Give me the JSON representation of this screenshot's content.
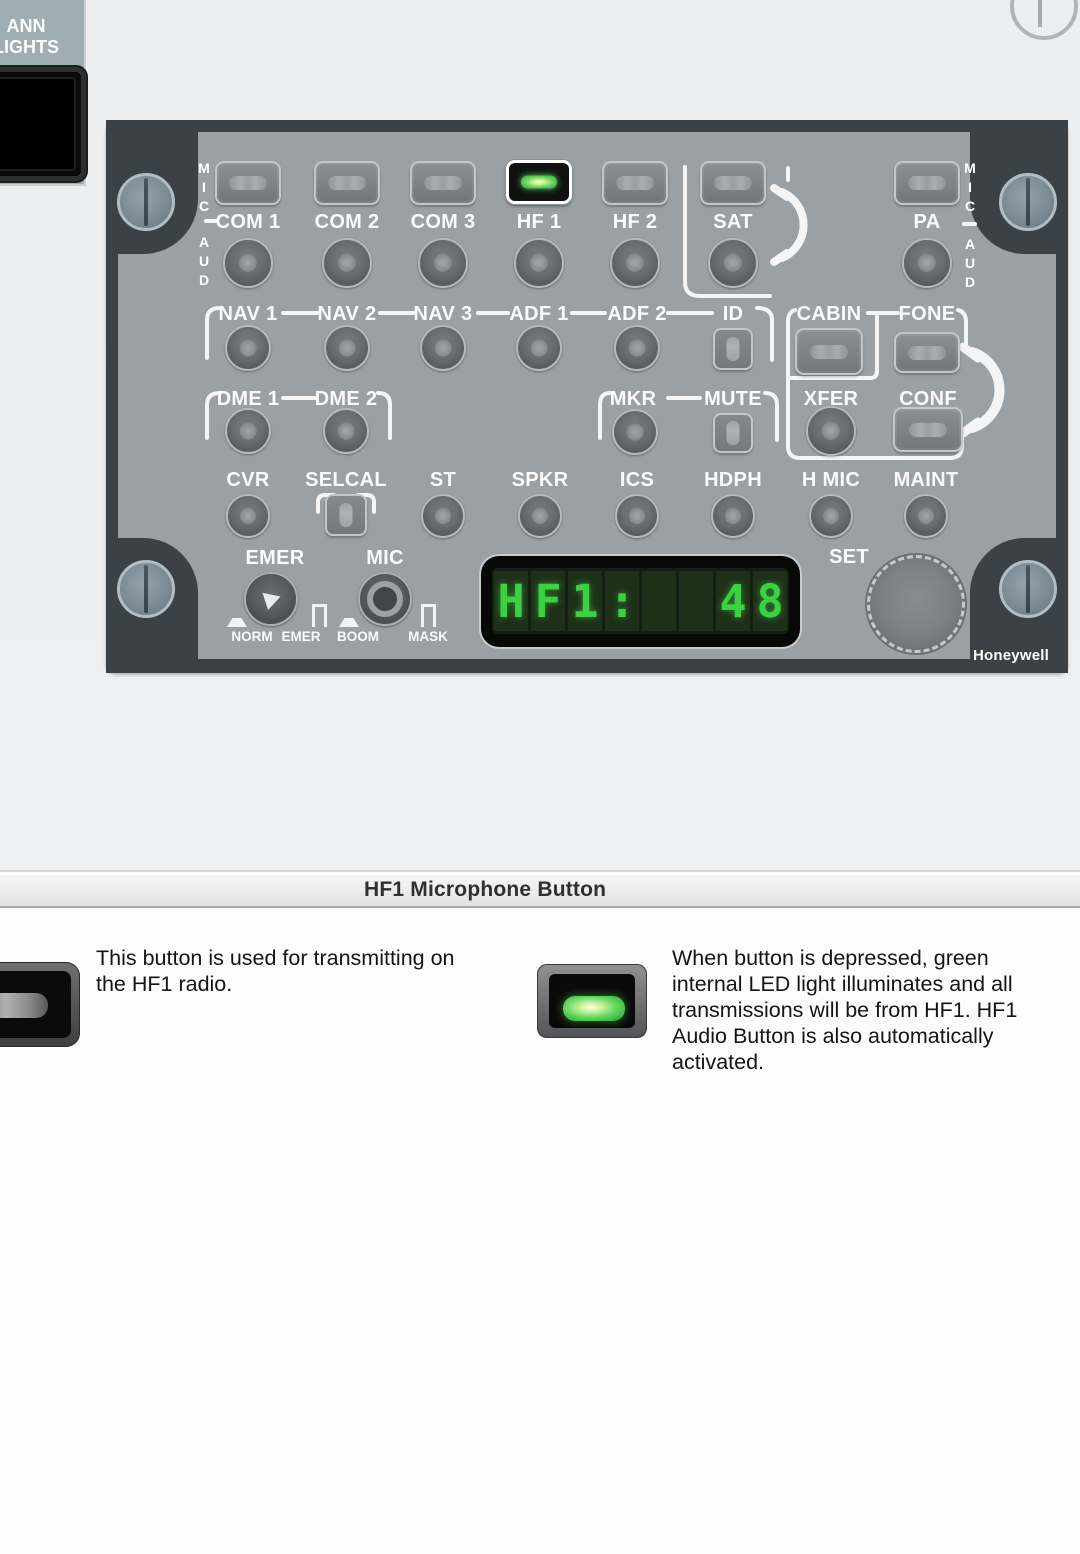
{
  "ann_plate": {
    "lines": [
      "ANN",
      "LIGHTS"
    ]
  },
  "header": {
    "title": "HF1 Microphone Button"
  },
  "panel": {
    "brand": "Honeywell",
    "rails": {
      "mic": "MIC",
      "aud": "AUD"
    },
    "labels": {
      "com1": "COM 1",
      "com2": "COM 2",
      "com3": "COM 3",
      "hf1": "HF 1",
      "hf2": "HF 2",
      "sat": "SAT",
      "pa": "PA",
      "nav1": "NAV 1",
      "nav2": "NAV 2",
      "nav3": "NAV 3",
      "adf1": "ADF 1",
      "adf2": "ADF 2",
      "id": "ID",
      "cabin": "CABIN",
      "fone": "FONE",
      "dme1": "DME 1",
      "dme2": "DME 2",
      "mkr": "MKR",
      "mute": "MUTE",
      "xfer": "XFER",
      "conf": "CONF",
      "cvr": "CVR",
      "selcal": "SELCAL",
      "st": "ST",
      "spkr": "SPKR",
      "ics": "ICS",
      "hdph": "HDPH",
      "hmic": "H MIC",
      "maint": "MAINT",
      "emer": "EMER",
      "mic": "MIC",
      "set": "SET"
    },
    "switch_positions": {
      "norm": "NORM",
      "emer": "EMER",
      "boom": "BOOM",
      "mask": "MASK"
    },
    "display": {
      "value": "HF1:    48",
      "cells": [
        "H",
        "F",
        "1",
        ":",
        "",
        "",
        "4",
        "8"
      ]
    }
  },
  "captions": {
    "left": {
      "lines": [
        "This button is used for transmitting on",
        "the HF1 radio."
      ]
    },
    "right": {
      "lines": [
        "When button is depressed, green",
        "internal LED light illuminates and all",
        "transmissions will be from HF1. HF1",
        "Audio Button is also automatically",
        "activated."
      ]
    }
  },
  "colors": {
    "panel_face": "#9aa1a4",
    "panel_frame": "#3b4247",
    "led_green": "#4ecb55",
    "display_green": "#3bd143",
    "highlight_white": "#ffffff"
  }
}
